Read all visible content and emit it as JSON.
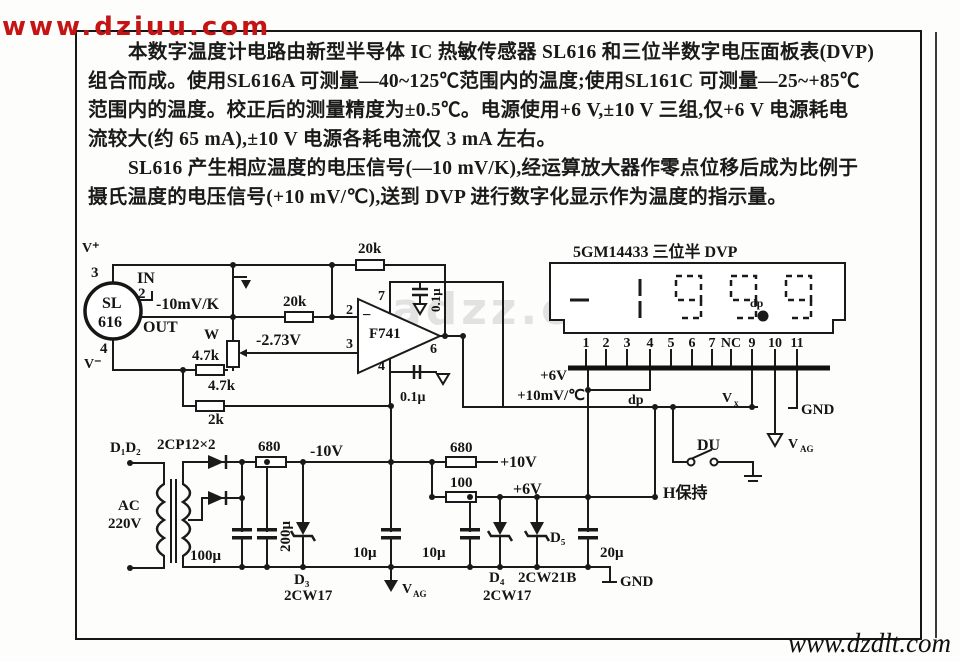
{
  "colors": {
    "ink": "#1a1a1a",
    "paper": "#fdfdfc",
    "watermark_red": "#c41414",
    "watermark_faint": "#cdcdcd"
  },
  "watermarks": {
    "top_left": "www.dziuu.com",
    "center_faint": "adzz.com",
    "bottom_right": "www.dzdlt.com"
  },
  "description": {
    "lines": [
      "本数字温度计电路由新型半导体 IC 热敏传感器 SL616 和三位半数字电压面板表(DVP)",
      "组合而成。使用SL616A 可测量—40~125℃范围内的温度;使用SL161C 可测量—25~+85℃",
      "范围内的温度。校正后的测量精度为±0.5℃。电源使用+6 V,±10 V 三组,仅+6 V 电源耗电",
      "流较大(约 65 mA),±10 V 电源各耗电流仅 3 mA 左右。",
      "SL616 产生相应温度的电压信号(—10 mV/K),经运算放大器作零点位移后成为比例于",
      "摄氏温度的电压信号(+10 mV/℃),送到 DVP 进行数字化显示作为温度的指示量。"
    ]
  },
  "schematic": {
    "sensor": {
      "pin3": "3",
      "pin2": "2",
      "pin4": "4",
      "v_plus": "V⁺",
      "v_minus": "V⁻",
      "in_label": "IN",
      "out_label": "OUT",
      "name_top": "SL",
      "name_bottom": "616",
      "signal": "-10mV/K"
    },
    "input_stage": {
      "r_series": "20k",
      "r_feedback": "20k",
      "pot_name": "W",
      "pot_value": "4.7k",
      "r_mid": "4.7k",
      "r_bottom": "2k",
      "offset_voltage": "-2.73V"
    },
    "opamp": {
      "name": "F741",
      "minus_sign": "−",
      "pin2": "2",
      "pin3": "3",
      "pin7": "7",
      "pin4": "4",
      "pin6": "6",
      "cap_top": "0.1μ",
      "cap_bottom": "0.1μ"
    },
    "dvp": {
      "title": "5GM14433 三位半 DVP",
      "dp_display": "dp",
      "pins": [
        "1",
        "2",
        "3",
        "4",
        "5",
        "6",
        "7",
        "NC",
        "9",
        "10",
        "11"
      ],
      "plus_6v": "+6V",
      "signal_in": "+10mV/℃",
      "dp_label": "dp",
      "vx": "V",
      "vx_sub": "x",
      "gnd": "GND",
      "vag": "V",
      "vag_sub": "AG",
      "du": "DU",
      "hold": "H保持"
    },
    "power": {
      "d1d2": "D₁D₂",
      "rectifier": "2CP12×2",
      "ac_line1": "AC",
      "ac_line2": "220V",
      "secondary": "12V",
      "c_100u": "100μ",
      "c_200u": "200μ",
      "r_680_left": "680",
      "rail_neg10": "-10V",
      "r_680_right": "680",
      "r_100": "100",
      "rail_pos10": "+10V",
      "rail_pos6": "+6V",
      "c_10u_left": "10μ",
      "c_10u_right": "10μ",
      "c_20u": "20μ",
      "d3_name": "D₃",
      "d3_type": "2CW17",
      "d4_name": "D₄",
      "d4_type": "2CW17",
      "d5_name": "D₅",
      "d5_type": "2CW21B",
      "gnd": "GND",
      "vag": "V",
      "vag_sub": "AG"
    }
  }
}
